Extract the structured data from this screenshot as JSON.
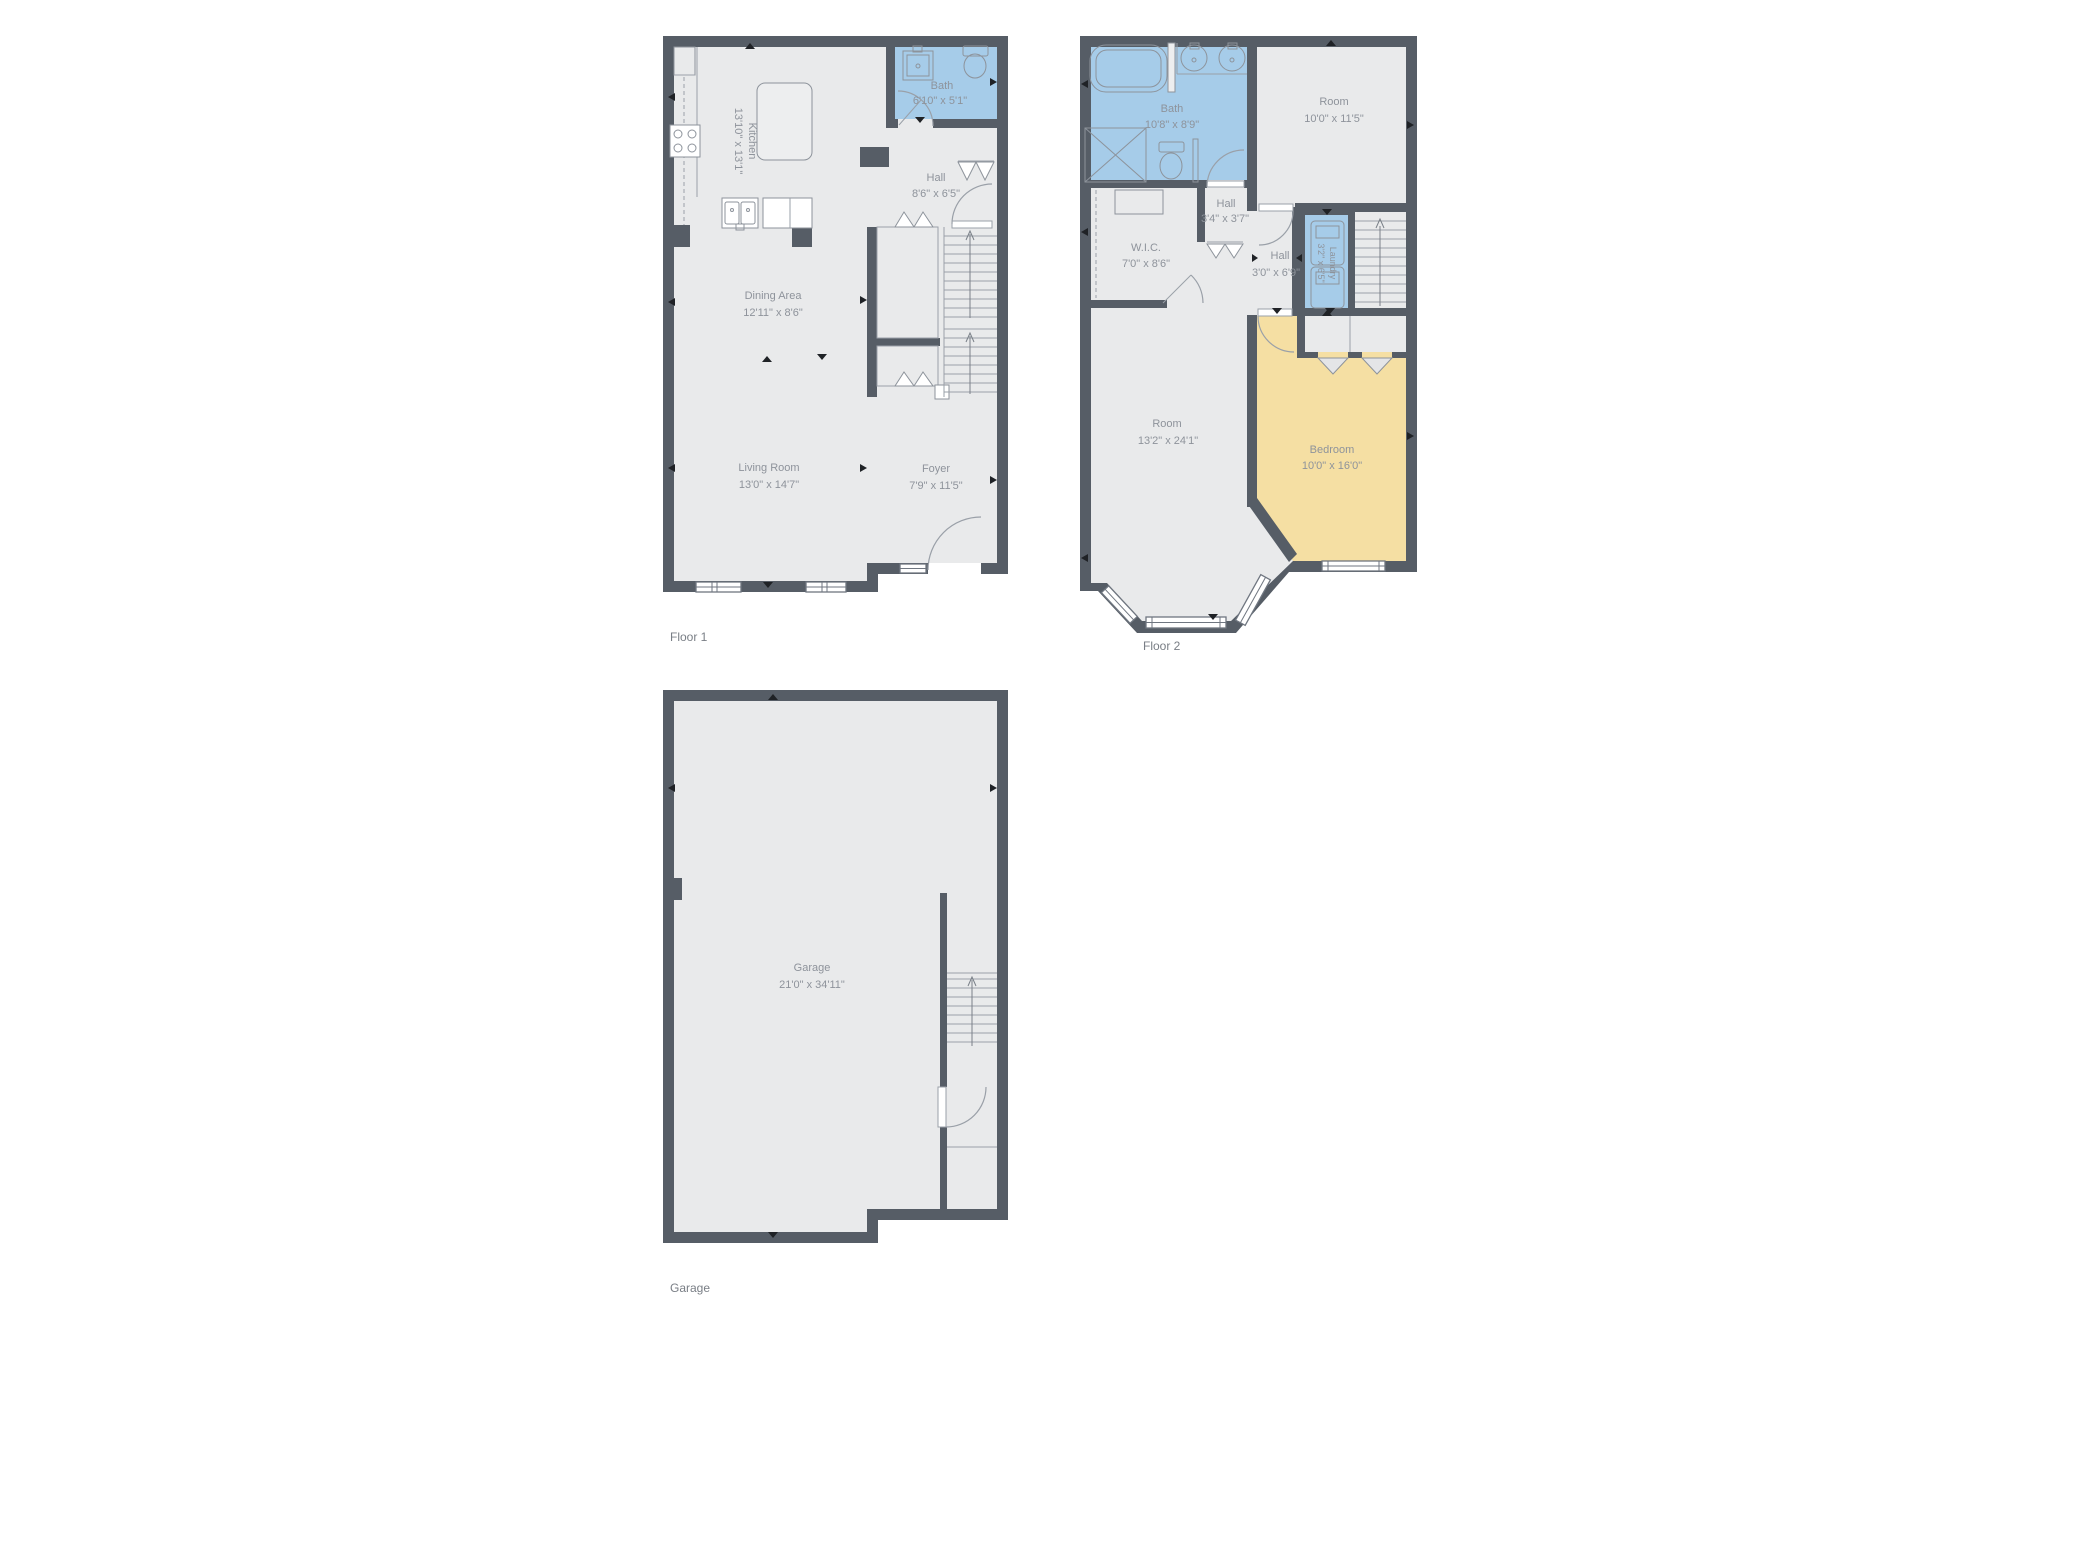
{
  "page": {
    "background": "#FFFFFF"
  },
  "colors": {
    "wall": "#565D66",
    "floor": "#E9EAEB",
    "room-blue": "#A6CCE9",
    "room-yellow": "#F5DFA3",
    "fixture-line": "#8D939B",
    "text": "#8E939B",
    "plan-label": "#797E85",
    "marker": "#1F2226"
  },
  "floors": {
    "floor1": {
      "label": "Floor 1",
      "rooms": {
        "kitchen": {
          "name": "Kitchen",
          "dims": "13'10\" x 13'1\""
        },
        "bath": {
          "name": "Bath",
          "dims": "6'10\" x 5'1\""
        },
        "hall": {
          "name": "Hall",
          "dims": "8'6\" x 6'5\""
        },
        "dining": {
          "name": "Dining Area",
          "dims": "12'11\" x 8'6\""
        },
        "living": {
          "name": "Living Room",
          "dims": "13'0\" x 14'7\""
        },
        "foyer": {
          "name": "Foyer",
          "dims": "7'9\" x 11'5\""
        }
      }
    },
    "floor2": {
      "label": "Floor 2",
      "rooms": {
        "bath": {
          "name": "Bath",
          "dims": "10'8\" x 8'9\""
        },
        "room_top": {
          "name": "Room",
          "dims": "10'0\" x 11'5\""
        },
        "hall_small": {
          "name": "Hall",
          "dims": "3'4\" x 3'7\""
        },
        "wic": {
          "name": "W.I.C.",
          "dims": "7'0\" x 8'6\""
        },
        "hall": {
          "name": "Hall",
          "dims": "3'0\" x 6'9\""
        },
        "laundry": {
          "name": "Laundry",
          "dims": "3'2\" x 6'5\""
        },
        "room_main": {
          "name": "Room",
          "dims": "13'2\" x 24'1\""
        },
        "bedroom": {
          "name": "Bedroom",
          "dims": "10'0\" x 16'0\""
        }
      }
    },
    "garage": {
      "label": "Garage",
      "rooms": {
        "garage": {
          "name": "Garage",
          "dims": "21'0\" x 34'11\""
        }
      }
    }
  }
}
